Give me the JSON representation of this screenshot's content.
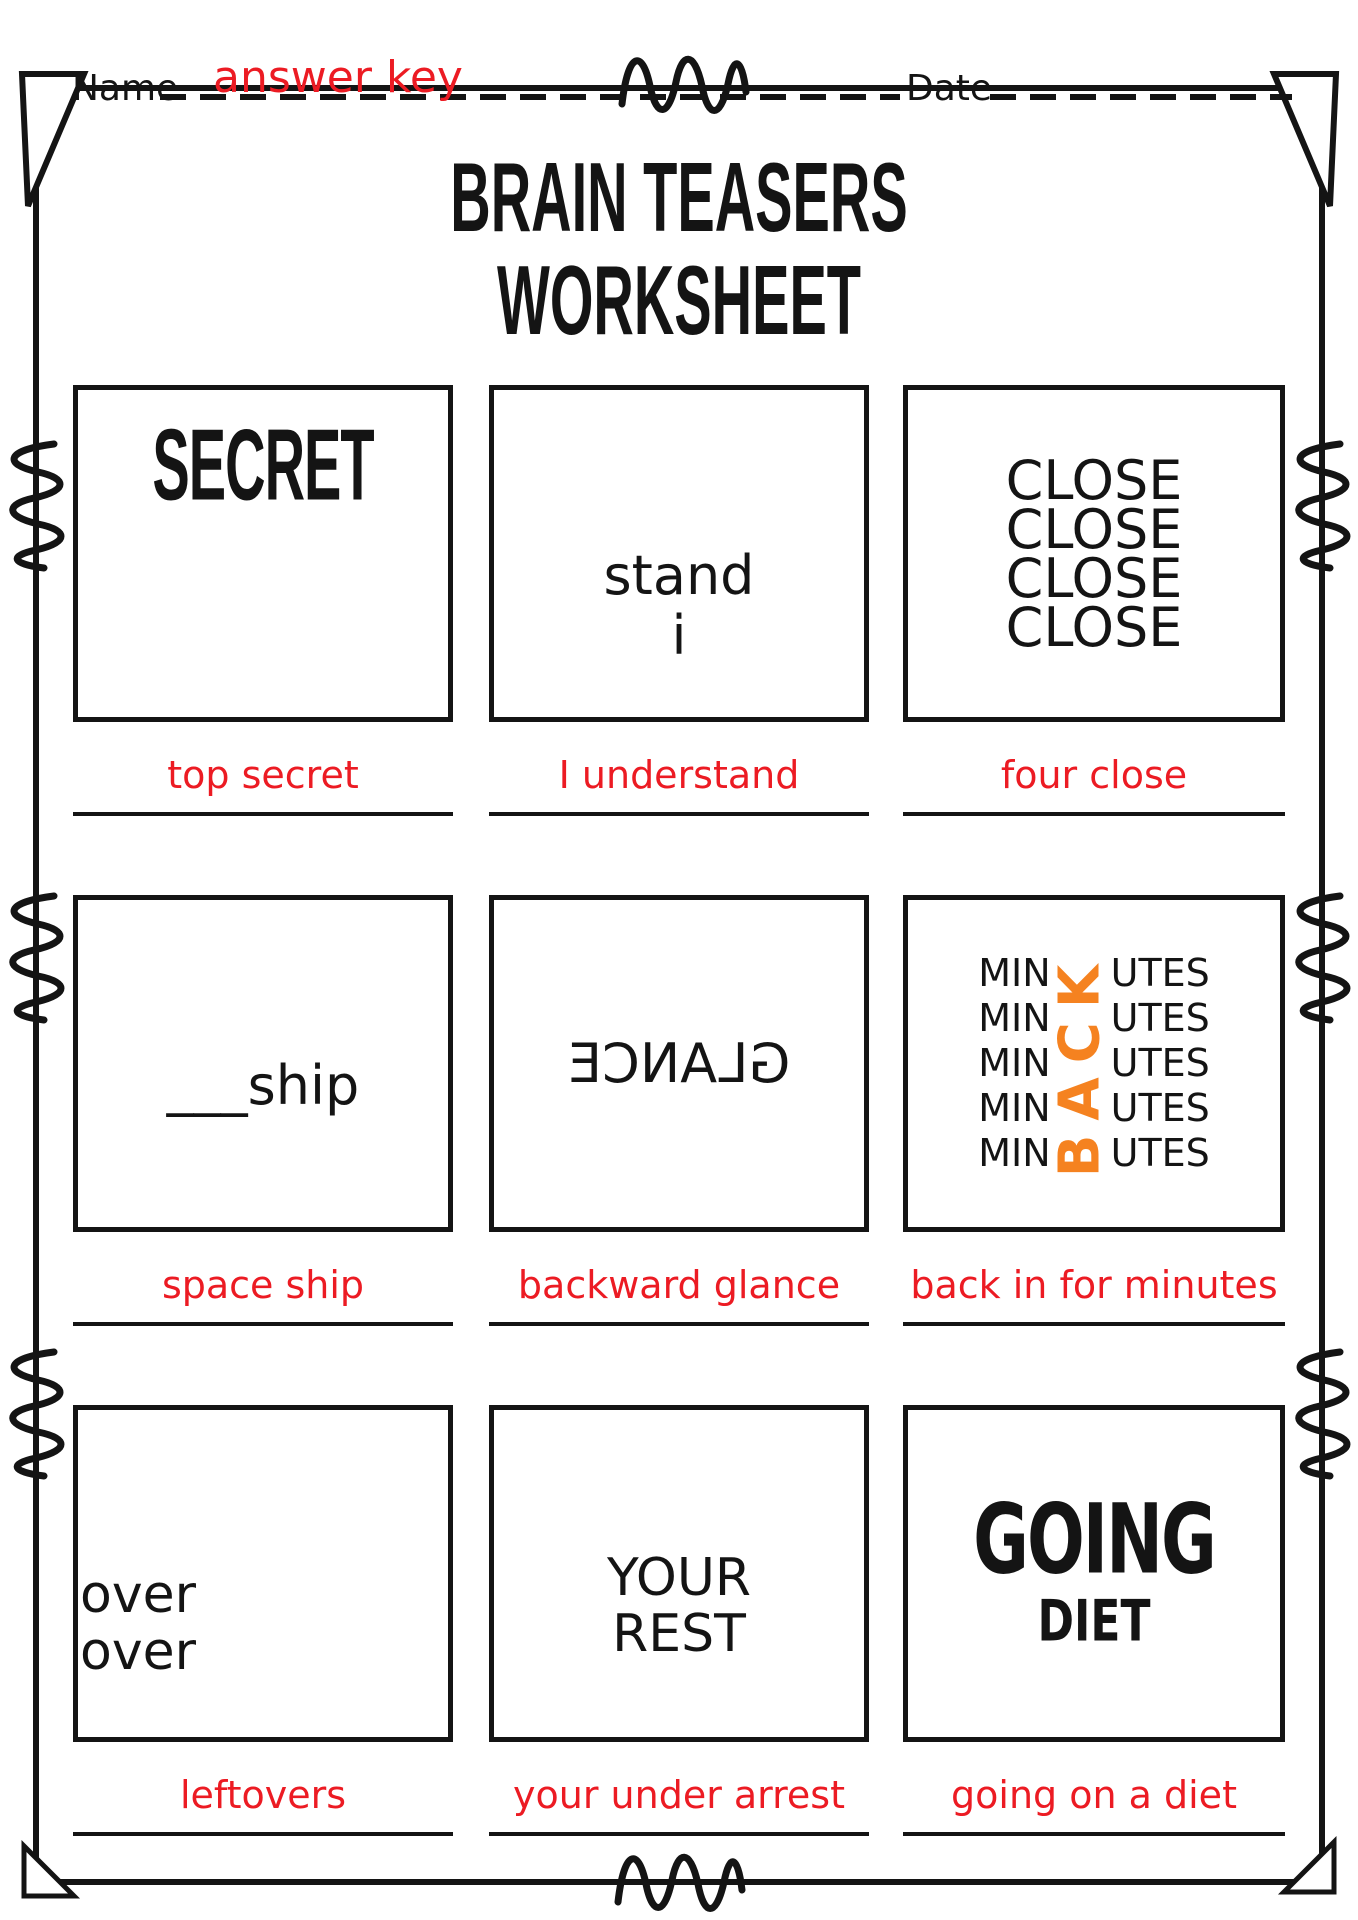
{
  "header": {
    "name_label": "Name",
    "name_value": "answer key",
    "date_label": "Date",
    "date_value": ""
  },
  "title": {
    "line1": "BRAIN TEASERS",
    "line2": "WORKSHEET"
  },
  "colors": {
    "answer_red": "#EC1B23",
    "accent_orange": "#F58220",
    "ink": "#141414"
  },
  "puzzles": [
    {
      "text": "SECRET",
      "answer": "top secret"
    },
    {
      "line1": "stand",
      "line2": "i",
      "answer": "I understand"
    },
    {
      "line1": "CLOSE",
      "line2": "CLOSE",
      "line3": "CLOSE",
      "line4": "CLOSE",
      "answer": "four close"
    },
    {
      "text": "___ship",
      "answer": "space ship"
    },
    {
      "text": "GLANCE",
      "mirrored": true,
      "answer": "backward glance"
    },
    {
      "left": "MIN",
      "right": "UTES",
      "rows": 5,
      "vertical_word": "BACK",
      "answer": "back in for minutes"
    },
    {
      "line1": "over",
      "line2": "over",
      "answer": "leftovers"
    },
    {
      "line1": "YOUR",
      "line2": "REST",
      "answer": "your under arrest"
    },
    {
      "line1": "GOING",
      "line2": "DIET",
      "answer": "going on a diet"
    }
  ]
}
